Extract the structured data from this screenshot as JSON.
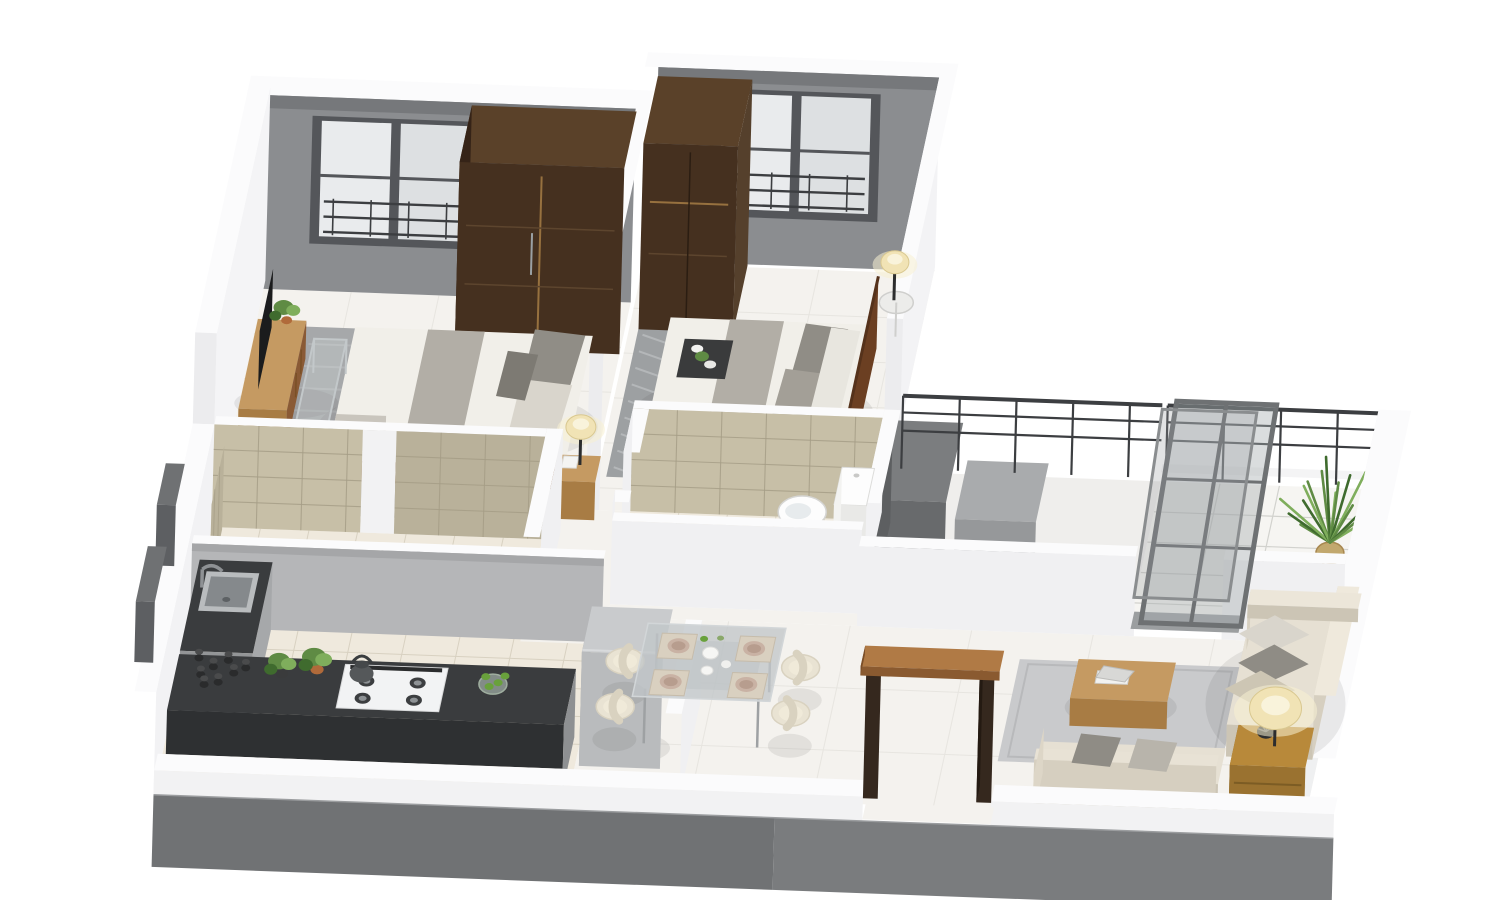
{
  "meta": {
    "title": "3D apartment floor plan render",
    "view": "isometric-cutaway",
    "background": "#ffffff"
  },
  "colors": {
    "wallCap": "#fbfbfc",
    "wallFace": "#f0f0f2",
    "wallFaceShade": "#e7e8ea",
    "wallEnd": "#ececee",
    "wallGray": "#8b8d90",
    "wallGrayDark": "#76787b",
    "kitchenWall": "#b5b6b8",
    "windowFrame": "#54565a",
    "windowPane": "#e9ebed",
    "windowPane2": "#dde0e2",
    "railDark": "#3c3e41",
    "fascia": "#707274",
    "frontWhite": "#f2f2f3",
    "floorTile": "#f4f2ee",
    "floorLine": "#e7e5e0",
    "floorBeige": "#efe9dd",
    "floorBeigeLine": "#d8d1c1",
    "balconyTile": "#f6f5f2",
    "balconyLine": "#d2d2ce",
    "ductFloor": "#efeeec",
    "marble": "#c7bfa7",
    "marbleLine": "#a59d86",
    "marbleSide": "#b9b19a",
    "rugGray": "#a6a8aa",
    "rugPattern": "#bfc1c3",
    "rugLiving": "#c9cacc",
    "rugLivingEdge": "#b8b9bb",
    "wardrobe": "#45301f",
    "wardrobeTop": "#5a4129",
    "wardrobeSide": "#352317",
    "handleLine": "#97713f",
    "woodLight": "#c59a62",
    "woodMid": "#a87c44",
    "woodDark": "#8a5a35",
    "headboard": "#6b3f22",
    "doorWood": "#b07a45",
    "doorWoodDark": "#8a5a30",
    "doorJamb": "#35281e",
    "linen": "#f1efe9",
    "linenShade": "#dcd8ce",
    "runner": "#b2aea6",
    "pillowGray": "#908d86",
    "pillowLight": "#d9d5cc",
    "sofa": "#e6e0d3",
    "sofaShade": "#d6cfc0",
    "sofaSide": "#ccc5b5",
    "cushGray": "#8f8c85",
    "counter": "#3a3c3e",
    "counterSide": "#2e3032",
    "cabinet": "#a6a8aa",
    "steel": "#b9bcbe",
    "steelInner": "#85898c",
    "steelDark": "#8e9194",
    "fridge": "#b9bbbd",
    "fridgeTop": "#c9cbcd",
    "fridgeSide": "#a3a5a7",
    "fixture": "#fdfdfd",
    "fixtureShade": "#e9e9e7",
    "fixtureInner": "#e7ebed",
    "lampShade": "#f1e3b5",
    "lampGlow": "#f8f0d2",
    "lampInner": "#f9f3dd",
    "glassFill": "rgba(168,173,176,0.42)",
    "glassFrame": "#6e7173",
    "plantGreen": "#5f8b44",
    "plantDark": "#3f6b2e",
    "plantLight": "#7fae5c",
    "potTerra": "#b06a3a",
    "potWicker": "#c2a86e",
    "tableGlass": "rgba(193,198,201,0.78)",
    "tableRim": "#d2d6d8",
    "plate": "#c9b2a4",
    "plateInner": "#b79d8e",
    "mat": "#d9d0c0",
    "dark": "#2c2d2e",
    "tvBlack": "#1b1c1d",
    "chairCream": "#e9e3d3",
    "chairEdge": "#d9d2c0",
    "chairInner": "#f0ead9",
    "jarDark": "#2a2b2c",
    "lime": "#69a13c",
    "bowlGlass": "rgba(190,205,195,0.55)",
    "shadow": "rgba(70,70,70,0.10)"
  },
  "scene": {
    "rooms": [
      {
        "name": "bedroom-1",
        "furniture": [
          "double-bed",
          "wardrobe",
          "tv-console",
          "nightstand",
          "table-lamp",
          "area-rug",
          "acrylic-bench",
          "window-with-railing"
        ]
      },
      {
        "name": "bedroom-2",
        "furniture": [
          "double-bed",
          "wardrobe",
          "bedside-tables",
          "table-lamps",
          "serving-tray",
          "area-rug",
          "window-with-railing",
          "wood-headboard"
        ]
      },
      {
        "name": "ensuite-bathroom",
        "furniture": [
          "toilet",
          "marble-tiled-walls",
          "floor-drain"
        ]
      },
      {
        "name": "common-bathroom",
        "furniture": [
          "washbasin",
          "shower-tray",
          "marble-tiled-walls"
        ]
      },
      {
        "name": "kitchen",
        "furniture": [
          "l-shaped-counter",
          "sink-with-faucet",
          "gas-hob",
          "kettle",
          "spice-jars",
          "potted-herbs",
          "fruit-bowl",
          "refrigerator"
        ]
      },
      {
        "name": "dining-area",
        "furniture": [
          "glass-dining-table",
          "dining-chairs",
          "tableware"
        ]
      },
      {
        "name": "living-room",
        "furniture": [
          "l-shaped-sofa",
          "coffee-table",
          "books",
          "side-table",
          "table-lamp",
          "area-rug"
        ]
      },
      {
        "name": "balcony",
        "furniture": [
          "railing",
          "potted-palm",
          "sliding-glass-door",
          "tiled-floor"
        ]
      },
      {
        "name": "entrance",
        "furniture": [
          "open-door-frame"
        ]
      }
    ]
  }
}
